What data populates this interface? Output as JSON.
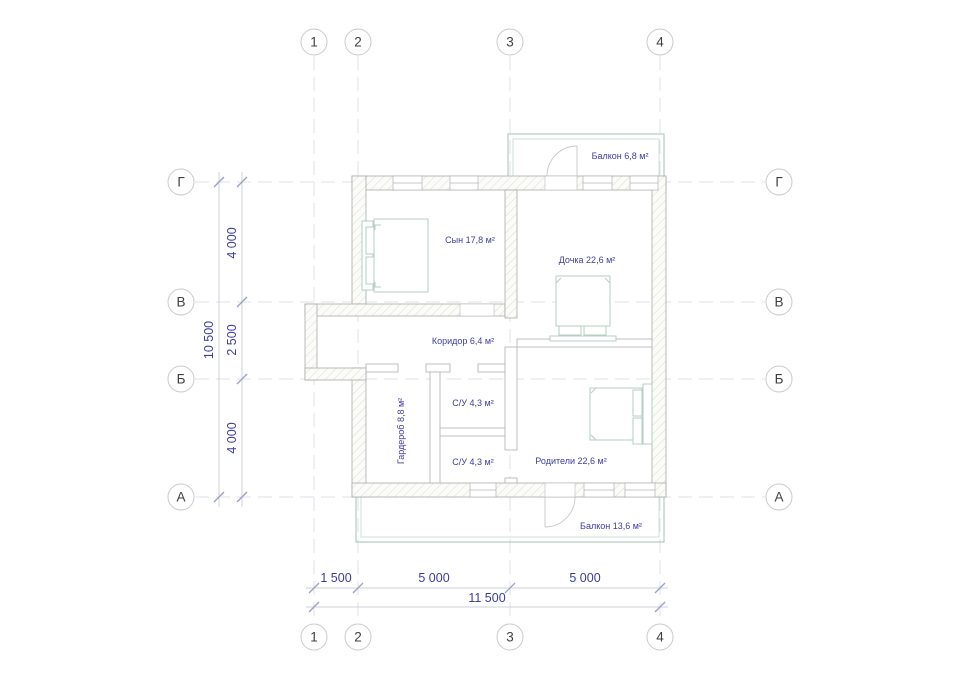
{
  "drawing_type": "floor-plan",
  "colors": {
    "room_label": "#3c3ca0",
    "dimension_text": "#3c3ca0",
    "axis_text": "#3f3f41",
    "grid_line": "#dde2e7",
    "wall_stroke": "#a9aca8",
    "hatch_line": "#dcdbd3",
    "furniture_stroke": "#b6cfc2",
    "balcony_stroke": "#a5c2b5"
  },
  "axes": {
    "columns": [
      "1",
      "2",
      "3",
      "4"
    ],
    "rows": [
      "Г",
      "В",
      "Б",
      "А"
    ]
  },
  "dimensions": {
    "bottom_segments": [
      "1 500",
      "5 000",
      "5 000"
    ],
    "bottom_total": "11 500",
    "left_segments": [
      "4 000",
      "2 500",
      "4 000"
    ],
    "left_total": "10 500"
  },
  "rooms": {
    "balcony_top": "Балкон 6,8 м²",
    "son": "Сын 17,8 м²",
    "daughter": "Дочка 22,6 м²",
    "corridor": "Коридор 6,4 м²",
    "wc_top": "С/У 4,3 м²",
    "wc_bottom": "С/У 4,3 м²",
    "wardrobe": "Гардероб 8,8 м²",
    "parents": "Родители 22,6 м²",
    "balcony_bottom": "Балкон 13,6 м²"
  }
}
